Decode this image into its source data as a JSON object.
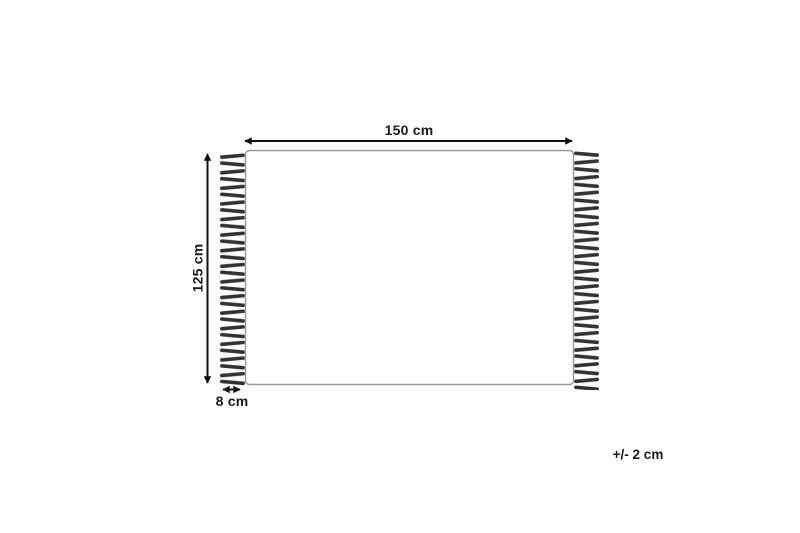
{
  "diagram": {
    "labels": {
      "width": "150 cm",
      "height": "125 cm",
      "fringe": "8 cm",
      "tolerance": "+/- 2 cm"
    },
    "colors": {
      "ink": "#1a1a1a",
      "arrow": "#111111",
      "rug_outline": "#9b9b9b",
      "rug_fill": "#ffffff",
      "fringe": "#333333",
      "background": "#ffffff"
    }
  }
}
